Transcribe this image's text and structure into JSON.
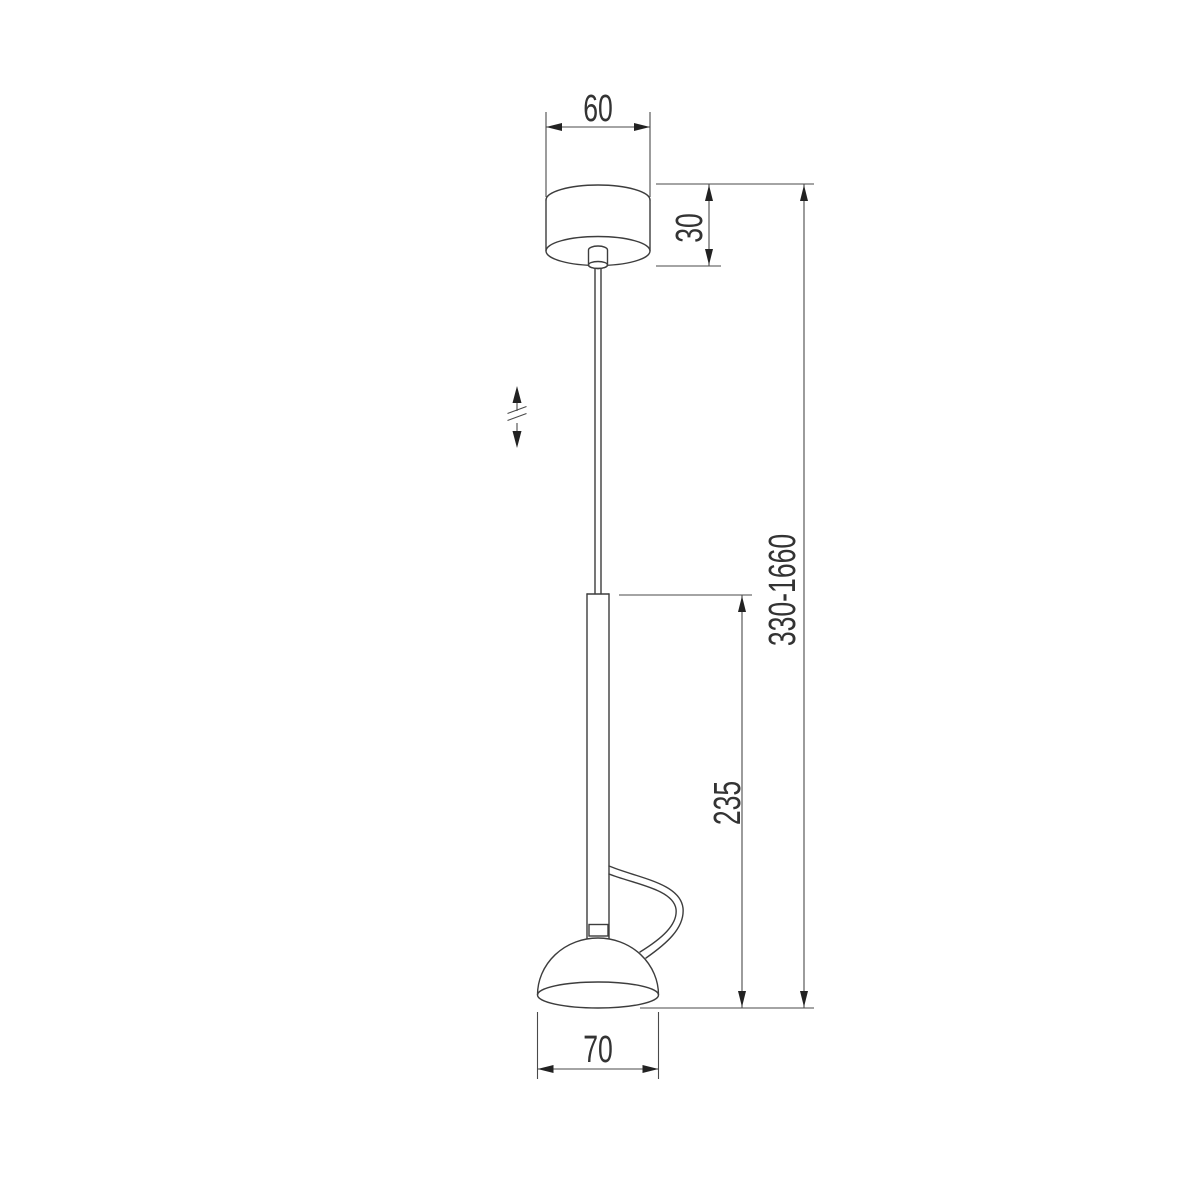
{
  "document": {
    "type": "technical-dimension-drawing",
    "subject": "pendant lamp suspension, side elevation",
    "units": "mm",
    "background": "#ffffff"
  },
  "colors": {
    "object_line": "#3d3d3d",
    "dimension_line": "#4a4a4a",
    "arrow_fill": "#222222",
    "text": "#333333"
  },
  "dimensions": {
    "canopy_width": "60",
    "canopy_height": "30",
    "body_height": "235",
    "overall_height": "330-1660",
    "shade_width": "70"
  },
  "icons": {
    "height_adjustable": "double-vertical-arrow-with-break-marks"
  }
}
